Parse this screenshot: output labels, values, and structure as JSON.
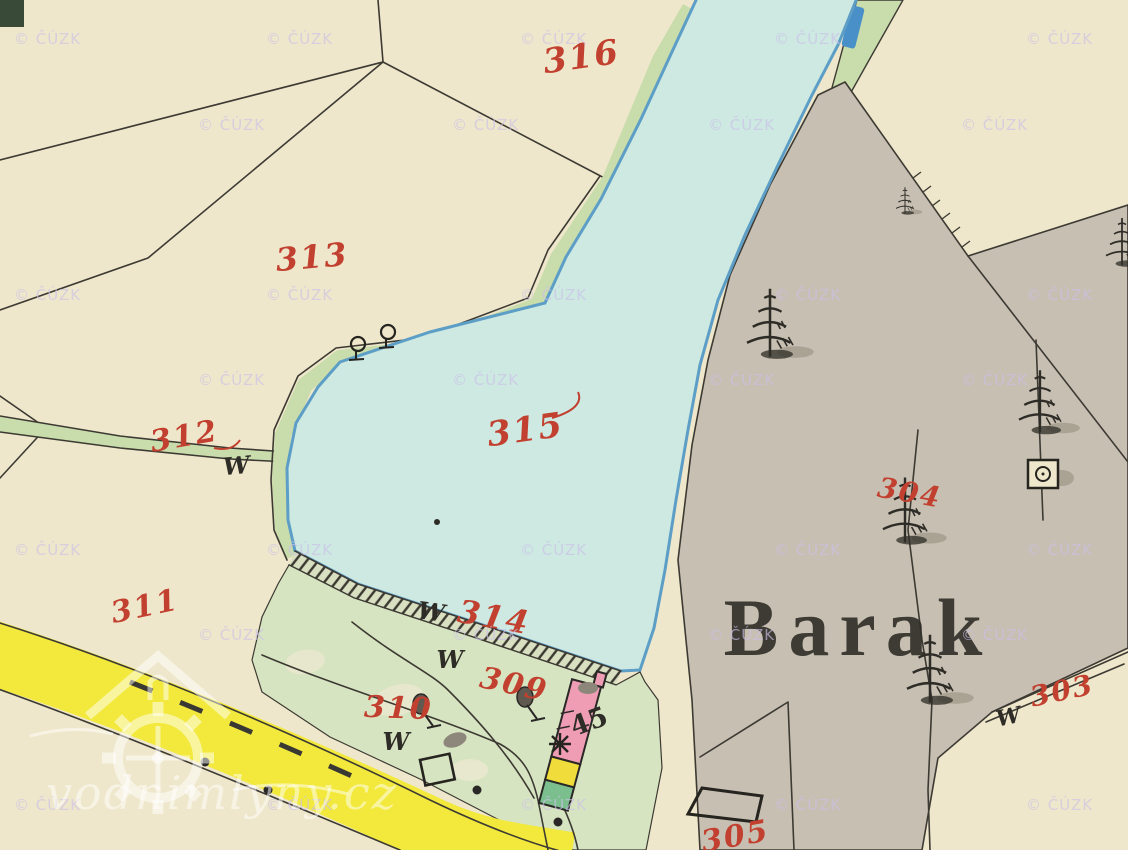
{
  "map_labels": {
    "place_name": "Barak",
    "house_number": "45",
    "meadow_mark": "W",
    "parcel_numbers": {
      "p316": "316",
      "p313": "313",
      "p312": "312",
      "p311": "311",
      "p315": "315",
      "p314": "314",
      "p309": "309",
      "p310": "310",
      "p304": "304",
      "p303": "303",
      "p305": "305"
    }
  },
  "watermarks": {
    "copyright": "© ČÚZK",
    "brand": "vodnimlyny.cz"
  },
  "colors": {
    "paper": "#efe7cb",
    "pond": "#cde9e2",
    "pond_edge": "#5d9ec6",
    "stream_blue": "#4a90c8",
    "bank_green": "#c9dcab",
    "meadow_green": "#d7e4c1",
    "common_gray": "#c7bfb2",
    "road_yellow": "#f2e93c",
    "building_masonry_pink": "#ee9db5",
    "building_yellow": "#f0dc3a",
    "building_green": "#7cbf8e",
    "parcel_number_red": "#c2402f",
    "ink": "#2e2c26"
  }
}
